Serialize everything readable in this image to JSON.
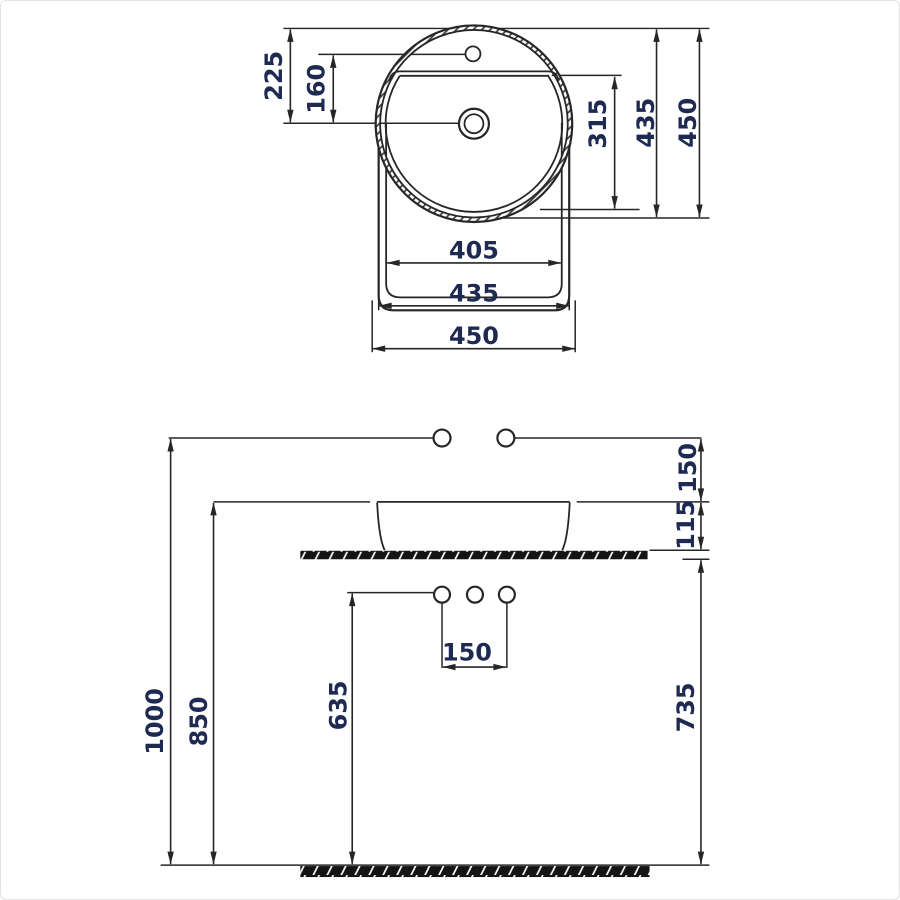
{
  "drawing_title": "Round countertop washbasin installation drawing",
  "colors": {
    "line": "#262626",
    "dimension_text": "#1e2a52",
    "slab_fill": "#141414",
    "background": "#ffffff"
  },
  "top_view": {
    "dim_rim_to_drain": "225",
    "dim_faucet_to_drain": "160",
    "dim_bowl_depth": "315",
    "dim_height_mid": "435",
    "dim_height_overall": "450",
    "dim_width_bowl": "405",
    "dim_width_mid": "435",
    "dim_width_overall": "450"
  },
  "front_view": {
    "dim_supply_to_rim": "150",
    "dim_basin_height": "115",
    "dim_supply_height": "1000",
    "dim_rim_height": "850",
    "dim_holes_height": "635",
    "dim_hole_spacing": "150",
    "dim_counter_height": "735"
  }
}
